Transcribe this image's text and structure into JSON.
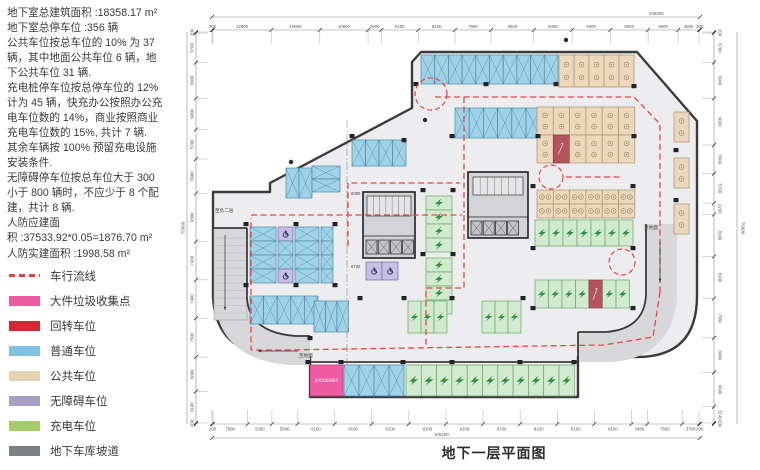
{
  "info_panel": {
    "text": "地下室总建筑面积 :18358.17 m²\n地下室总停车位 :356 辆\n公共车位按总车位的 10% 为 37\n辆，其中地面公共车位 6 辆，地\n下公共车位 31 辆.\n充电桩停车位按总停车位的 12%\n计为 45 辆，快充办公按照办公充\n电车位数的 14%，商业按照商业\n充电车位数的 15%, 共计 7 辆.\n其余车辆按 100% 预留充电设施\n安装条件.\n无障碍停车位按总车位大于 300\n小于 800 辆时，不应少于 8 个配\n建，共计 8 辆.\n人防应建面\n积 :37533.92*0.05=1876.70 m²\n人防实建面积 :1998.58 m²"
  },
  "title": "地下一层平面图",
  "legend": {
    "items": [
      {
        "kind": "dash",
        "label": "车行流线",
        "color": "#e8413c"
      },
      {
        "kind": "swatch",
        "label": "大件垃圾收集点",
        "color": "#ee5ba0"
      },
      {
        "kind": "swatch",
        "label": "回转车位",
        "color": "#cf2a36"
      },
      {
        "kind": "swatch",
        "label": "普通车位",
        "color": "#82c1e2"
      },
      {
        "kind": "swatch",
        "label": "公共车位",
        "color": "#e6d3b3"
      },
      {
        "kind": "swatch",
        "label": "无障碍车位",
        "color": "#a89ec5"
      },
      {
        "kind": "swatch",
        "label": "充电车位",
        "color": "#a5cc6b"
      },
      {
        "kind": "swatch",
        "label": "地下车库坡道",
        "color": "#7e8184"
      }
    ]
  },
  "plan": {
    "pink_label": "大件垃圾收集点",
    "colors": {
      "bg": "#ededef",
      "wall": "#3b3b3d",
      "ramp": "#d8d8da",
      "route": "#e8453f",
      "dim": "#8a8a8a",
      "dimtext": "#555555",
      "N_fill": "#9fd3e8",
      "N_stroke": "#4c86aa",
      "P_fill": "#ecd9bc",
      "P_stroke": "#a8906c",
      "C_fill": "#d2ead0",
      "C_stroke": "#67a567",
      "D_fill": "#c6c0e2",
      "D_stroke": "#6f68a8",
      "R_fill": "#b4535c",
      "R_stroke": "#8a3840",
      "K_fill": "#ee5ba0",
      "K_stroke": "#c23a82",
      "core_fill": "#d4d4d6",
      "bolt": "#2f8f3c",
      "wheel": "#1c1c60",
      "pcircle": "#93805c"
    },
    "footprint": "M412,62 L421,52 L637,52 L697,121 L697,296 Q697,357 637,357 L578,357 L578,397 L310,397 L310,357 L277,357 Q216,353 213,297 L213,192 L270,192 L270,183 L412,108 Z",
    "ramp_bands": [
      {
        "d": "M230,232 L230,298 Q232,346 290,350 L310,350",
        "w": 30
      },
      {
        "d": "M662,224 L662,294 Q660,344 610,347 L579,347",
        "w": 30
      }
    ],
    "walls": [
      "M247,228 L247,297 Q248,332 295,336 L310,336",
      "M213,228 L247,228",
      "M646,224 L646,294 Q645,329 606,332 L578,332",
      "M578,332 L578,357",
      "M310,362 L578,362"
    ],
    "dims": {
      "top": {
        "segments": [
          200,
          12800,
          10680,
          10600,
          2900,
          8100,
          8100,
          7900,
          9400,
          8400,
          8400,
          8300,
          6600,
          4600,
          200
        ],
        "total": "106200"
      },
      "bottom": {
        "segments": [
          200,
          7580,
          5300,
          5580,
          8100,
          8100,
          8100,
          8100,
          8100,
          8100,
          8100,
          8100,
          8100,
          3480,
          7580,
          3700,
          200
        ],
        "total": "106200"
      },
      "left": {
        "segments": [
          200,
          5700,
          6900,
          6000,
          5700,
          6600,
          9300,
          7400,
          7400,
          7500,
          6600,
          6100,
          200
        ],
        "total": "75600"
      },
      "right": {
        "segments": [
          200,
          5700,
          6900,
          9000,
          5500,
          5700,
          2200,
          8100,
          8100,
          7580,
          6680,
          6600,
          3140,
          200
        ],
        "total": "75600"
      }
    },
    "labels": [
      {
        "text": "至负二层",
        "x": 215,
        "y": 212,
        "size": 4.6
      },
      {
        "text": "至地面",
        "x": 299,
        "y": 357,
        "size": 4.6
      },
      {
        "text": "至地面",
        "x": 644,
        "y": 229,
        "size": 4.6
      },
      {
        "text": "6080",
        "x": 351,
        "y": 195,
        "size": 4.2
      },
      {
        "text": "6730",
        "x": 351,
        "y": 268,
        "size": 4.2
      }
    ],
    "cores": [
      {
        "x": 363,
        "y": 192,
        "w": 52,
        "h": 66,
        "sub": [
          367,
          196,
          44,
          20
        ],
        "cells": {
          "x": 366,
          "y": 240,
          "n": 4,
          "cw": 11,
          "ch": 14
        }
      },
      {
        "x": 468,
        "y": 172,
        "w": 60,
        "h": 66,
        "sub": [
          473,
          177,
          50,
          18
        ],
        "cells": {
          "x": 471,
          "y": 221,
          "n": 4,
          "cw": 11,
          "ch": 14
        }
      }
    ],
    "stall_groups": [
      {
        "t": "N",
        "x": 421,
        "y": 55,
        "dir": "h",
        "n": 10,
        "sw": 13.7,
        "sl": 29
      },
      {
        "t": "P",
        "x": 559,
        "y": 55,
        "dir": "h",
        "n": 5,
        "sw": 15,
        "sl": 32
      },
      {
        "t": "N",
        "x": 455,
        "y": 108,
        "dir": "h",
        "n": 6,
        "sw": 14.2,
        "sl": 30
      },
      {
        "t": "P",
        "x": 537,
        "y": 107,
        "dir": "h",
        "n": 6,
        "sw": 16.3,
        "sl": 28
      },
      {
        "t": "P",
        "x": 537,
        "y": 135,
        "dir": "h",
        "n": 1,
        "sw": 16.3,
        "sl": 28
      },
      {
        "t": "R",
        "x": 553.3,
        "y": 135,
        "dir": "h",
        "n": 1,
        "sw": 16.3,
        "sl": 28
      },
      {
        "t": "P",
        "x": 569.6,
        "y": 135,
        "dir": "h",
        "n": 4,
        "sw": 16.3,
        "sl": 28
      },
      {
        "t": "P",
        "x": 537,
        "y": 190,
        "dir": "h",
        "n": 6,
        "sw": 16.3,
        "sl": 14
      },
      {
        "t": "P",
        "x": 537,
        "y": 204,
        "dir": "h",
        "n": 6,
        "sw": 16.3,
        "sl": 14
      },
      {
        "t": "P",
        "x": 674,
        "y": 112,
        "dir": "h",
        "n": 1,
        "sw": 15,
        "sl": 30
      },
      {
        "t": "P",
        "x": 674,
        "y": 158,
        "dir": "h",
        "n": 1,
        "sw": 15,
        "sl": 30
      },
      {
        "t": "P",
        "x": 674,
        "y": 204,
        "dir": "h",
        "n": 1,
        "sw": 15,
        "sl": 30
      },
      {
        "t": "N",
        "x": 352,
        "y": 140,
        "dir": "h",
        "n": 4,
        "sw": 13.5,
        "sl": 26
      },
      {
        "t": "N",
        "x": 286,
        "y": 168,
        "dir": "h",
        "n": 2,
        "sw": 13,
        "sl": 30
      },
      {
        "t": "N",
        "x": 312,
        "y": 166,
        "dir": "v",
        "n": 2,
        "sw": 13,
        "sl": 28
      },
      {
        "t": "N",
        "x": 250,
        "y": 227,
        "dir": "v",
        "n": 4,
        "sw": 14,
        "sl": 26
      },
      {
        "t": "M",
        "x": 278,
        "y": 227,
        "dir": "v",
        "n": 4,
        "sw": 14,
        "sl": 15,
        "cells": [
          "D",
          "N",
          "N",
          "D"
        ]
      },
      {
        "t": "N",
        "x": 295,
        "y": 227,
        "dir": "v",
        "n": 4,
        "sw": 14,
        "sl": 24
      },
      {
        "t": "N",
        "x": 321,
        "y": 227,
        "dir": "v",
        "n": 4,
        "sw": 14,
        "sl": 12
      },
      {
        "t": "N",
        "x": 250,
        "y": 296,
        "dir": "h",
        "n": 5,
        "sw": 13.6,
        "sl": 28
      },
      {
        "t": "N",
        "x": 314,
        "y": 301,
        "dir": "h",
        "n": 3,
        "sw": 11.5,
        "sl": 31
      },
      {
        "t": "C",
        "x": 426,
        "y": 196,
        "dir": "v",
        "n": 4,
        "sw": 14,
        "sl": 26
      },
      {
        "t": "C",
        "x": 426,
        "y": 258,
        "dir": "v",
        "n": 4,
        "sw": 14,
        "sl": 26
      },
      {
        "t": "D",
        "x": 366,
        "y": 262,
        "dir": "h",
        "n": 2,
        "sw": 16,
        "sl": 18
      },
      {
        "t": "C",
        "x": 408,
        "y": 301,
        "dir": "h",
        "n": 3,
        "sw": 13,
        "sl": 32
      },
      {
        "t": "C",
        "x": 482,
        "y": 301,
        "dir": "h",
        "n": 3,
        "sw": 13,
        "sl": 32
      },
      {
        "t": "C",
        "x": 535,
        "y": 220,
        "dir": "h",
        "n": 7,
        "sw": 14,
        "sl": 26
      },
      {
        "t": "C",
        "x": 535,
        "y": 280,
        "dir": "h",
        "n": 4,
        "sw": 13.5,
        "sl": 28
      },
      {
        "t": "R",
        "x": 589,
        "y": 280,
        "dir": "h",
        "n": 1,
        "sw": 13.5,
        "sl": 28
      },
      {
        "t": "C",
        "x": 602.5,
        "y": 280,
        "dir": "h",
        "n": 2,
        "sw": 13.5,
        "sl": 28
      },
      {
        "t": "K",
        "x": 310,
        "y": 365,
        "dir": "h",
        "n": 1,
        "sw": 33,
        "sl": 31
      },
      {
        "t": "N",
        "x": 344,
        "y": 365,
        "dir": "h",
        "n": 4,
        "sw": 15,
        "sl": 31
      },
      {
        "t": "C",
        "x": 406,
        "y": 365,
        "dir": "h",
        "n": 11,
        "sw": 15.3,
        "sl": 31
      }
    ],
    "routes": [
      [
        [
          435,
          97
        ],
        [
          634,
          97
        ],
        [
          660,
          124
        ],
        [
          660,
          292
        ]
      ],
      [
        [
          660,
          292
        ],
        [
          653,
          337
        ],
        [
          604,
          345
        ],
        [
          283,
          350
        ],
        [
          251,
          350
        ],
        [
          251,
          218
        ]
      ],
      [
        [
          251,
          215
        ],
        [
          462,
          215
        ]
      ],
      [
        [
          464,
          97
        ],
        [
          464,
          213
        ]
      ],
      [
        [
          464,
          215
        ],
        [
          464,
          288
        ],
        [
          426,
          288
        ],
        [
          426,
          348
        ]
      ],
      [
        [
          348,
          246
        ],
        [
          348,
          183
        ],
        [
          460,
          183
        ]
      ],
      [
        [
          566,
          177
        ],
        [
          620,
          177
        ]
      ]
    ],
    "circles": [
      {
        "cx": 431,
        "cy": 94,
        "r": 16
      },
      {
        "cx": 551,
        "cy": 177,
        "r": 12
      },
      {
        "cx": 622,
        "cy": 262,
        "r": 13
      }
    ],
    "arrows": [
      {
        "x1": 225,
        "y1": 235,
        "x2": 225,
        "y2": 310
      },
      {
        "x1": 298,
        "y1": 351,
        "x2": 258,
        "y2": 351
      },
      {
        "x1": 660,
        "y1": 242,
        "x2": 660,
        "y2": 282
      }
    ],
    "columns": [
      [
        416,
        84
      ],
      [
        486,
        84
      ],
      [
        556,
        84
      ],
      [
        634,
        86
      ],
      [
        452,
        136
      ],
      [
        538,
        136
      ],
      [
        634,
        136
      ],
      [
        352,
        136
      ],
      [
        404,
        140
      ],
      [
        246,
        224
      ],
      [
        296,
        224
      ],
      [
        335,
        224
      ],
      [
        246,
        285
      ],
      [
        296,
        285
      ],
      [
        335,
        285
      ],
      [
        423,
        190
      ],
      [
        453,
        190
      ],
      [
        423,
        254
      ],
      [
        453,
        254
      ],
      [
        533,
        186
      ],
      [
        633,
        186
      ],
      [
        533,
        248
      ],
      [
        633,
        248
      ],
      [
        533,
        308
      ],
      [
        633,
        308
      ],
      [
        308,
        362
      ],
      [
        341,
        362
      ],
      [
        403,
        362
      ],
      [
        452,
        362
      ],
      [
        520,
        362
      ],
      [
        574,
        362
      ],
      [
        360,
        298
      ],
      [
        404,
        298
      ],
      [
        452,
        298
      ],
      [
        523,
        298
      ],
      [
        676,
        150
      ],
      [
        676,
        200
      ],
      [
        310,
        338
      ]
    ],
    "dots": [
      [
        291,
        162
      ],
      [
        425,
        120
      ],
      [
        566,
        40
      ]
    ]
  }
}
